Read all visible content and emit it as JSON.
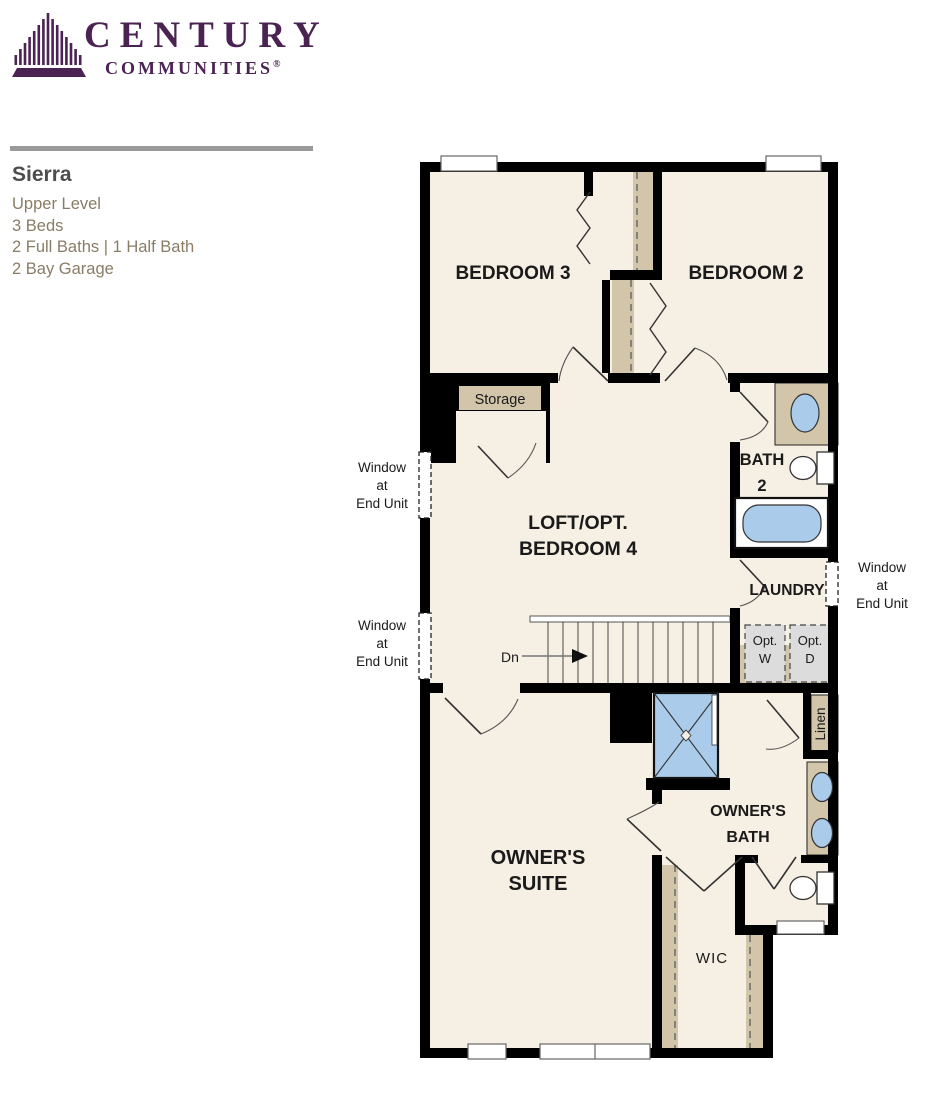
{
  "brand": {
    "name": "CENTURY",
    "subname": "COMMUNITIES",
    "registered": "®"
  },
  "plan_info": {
    "name": "Sierra",
    "level": "Upper Level",
    "beds": "3 Beds",
    "baths": "2 Full Baths | 1 Half Bath",
    "garage": "2 Bay Garage"
  },
  "floorplan": {
    "rooms": {
      "bedroom3": "BEDROOM 3",
      "bedroom2": "BEDROOM 2",
      "bath2_line1": "BATH",
      "bath2_line2": "2",
      "loft_line1": "LOFT/OPT.",
      "loft_line2": "BEDROOM 4",
      "laundry": "LAUNDRY",
      "storage": "Storage",
      "owners_suite_line1": "OWNER'S",
      "owners_suite_line2": "SUITE",
      "owners_bath_line1": "OWNER'S",
      "owners_bath_line2": "BATH",
      "wic": "WIC",
      "linen": "Linen"
    },
    "labels": {
      "stairs_down": "Dn",
      "opt_washer_line1": "Opt.",
      "opt_washer_line2": "W",
      "opt_dryer_line1": "Opt.",
      "opt_dryer_line2": "D",
      "window_end_unit_line1": "Window",
      "window_end_unit_line2": "at",
      "window_end_unit_line3": "End Unit"
    },
    "colors": {
      "wall": "#000000",
      "floor": "#f6efe3",
      "closet_tan": "#d2c5aa",
      "fixture_blue": "#aacbea",
      "optional_gray": "#dcdcdc",
      "brand_purple": "#4b2353"
    }
  }
}
